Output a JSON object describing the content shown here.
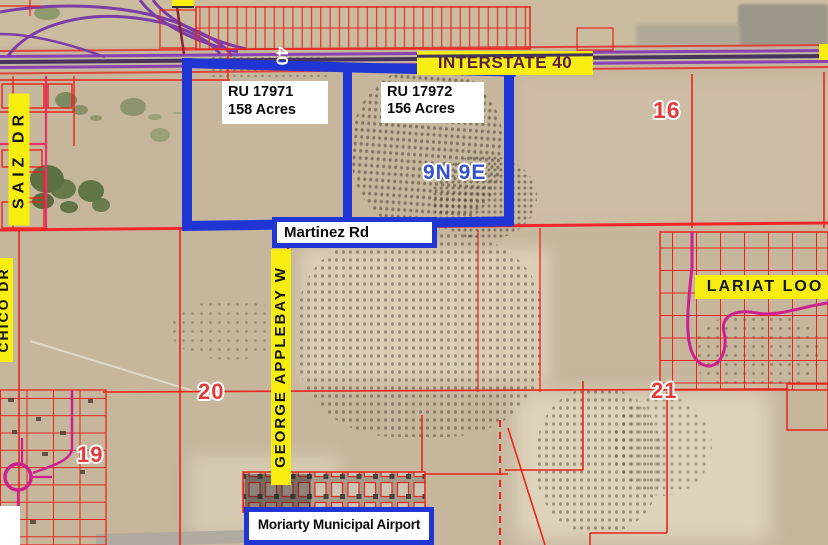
{
  "map": {
    "highway_label": "INTERSTATE 40",
    "route_marker": "40",
    "township_label": "9N 9E",
    "parcels": [
      {
        "id": "RU 17971",
        "acres": "158 Acres"
      },
      {
        "id": "RU 17972",
        "acres": "156 Acres"
      }
    ],
    "sections": {
      "s16": "16",
      "s19": "19",
      "s20": "20",
      "s21": "21"
    },
    "roads": {
      "martinez": "Martinez Rd",
      "saiz": "SAIZ DR",
      "chico": "CHICO DR",
      "george_applebay": "GEORGE APPLEBAY W",
      "lariat": "LARIAT LOO"
    },
    "airport_label": "Moriarty Municipal Airport",
    "colors": {
      "parcel_highlight": "#1f35d4",
      "parcel_lines": "#e8251f",
      "highway_lines": "#8a41b4",
      "section_label_text": "#e23b3c",
      "township_label_text": "#3553c9",
      "road_label_bg": "#f7ee0f",
      "highway_label_text": "#5a1f3e"
    }
  }
}
